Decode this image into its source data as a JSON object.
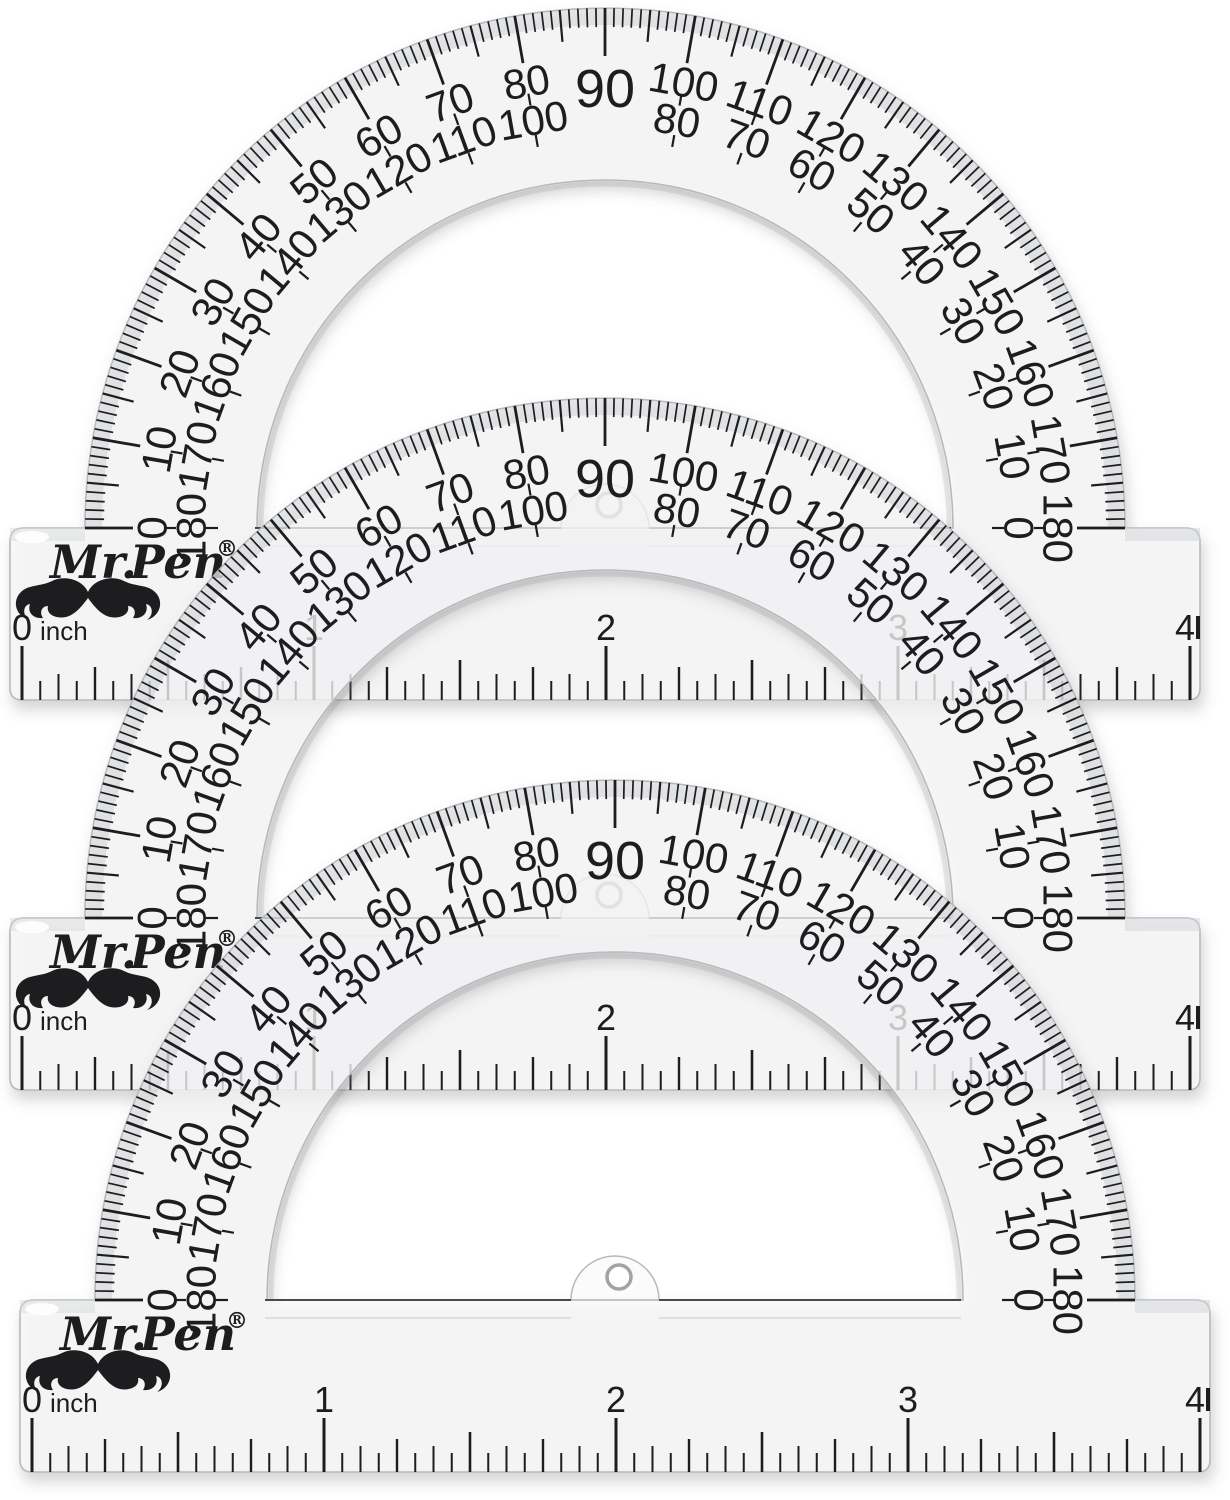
{
  "product": {
    "brand": {
      "logo_prefix": "Mr.",
      "logo_main": "Pen",
      "registered_mark": "®",
      "icons": [
        "mustache-icon",
        "crown-icon"
      ]
    },
    "protractor": {
      "shared_apex_label": "90",
      "outer_scale_labels": [
        "0",
        "10",
        "20",
        "30",
        "40",
        "50",
        "60",
        "70",
        "80",
        "100",
        "110",
        "120",
        "130",
        "140",
        "150",
        "160",
        "170",
        "180"
      ],
      "inner_scale_labels": [
        "180",
        "170",
        "160",
        "150",
        "140",
        "130",
        "120",
        "110",
        "100",
        "80",
        "70",
        "60",
        "50",
        "40",
        "30",
        "20",
        "10",
        "0"
      ],
      "degree_tick_step_minor": 1,
      "degree_tick_step_mid": 5,
      "degree_tick_step_major": 10,
      "ruler": {
        "unit": "inch",
        "labels": [
          "0",
          "1",
          "2",
          "3",
          "4"
        ],
        "divisions_per_inch": 16
      }
    },
    "instances": [
      {
        "name": "protractor-top",
        "dx": 0,
        "dy": 0
      },
      {
        "name": "protractor-middle",
        "dx": 0,
        "dy": 390
      },
      {
        "name": "protractor-bottom",
        "dx": 10,
        "dy": 772
      }
    ]
  },
  "colors": {
    "background": "#ffffff",
    "ink": "#1d1d1f",
    "plastic_fill": "rgba(250,250,251,0.72)",
    "plastic_edge": "#b6babc",
    "bevel": "#d3d6d8",
    "shadow": "#6b6b6b",
    "ridge": "#dcdfe1",
    "hole_ring": "#a0a4a6"
  }
}
